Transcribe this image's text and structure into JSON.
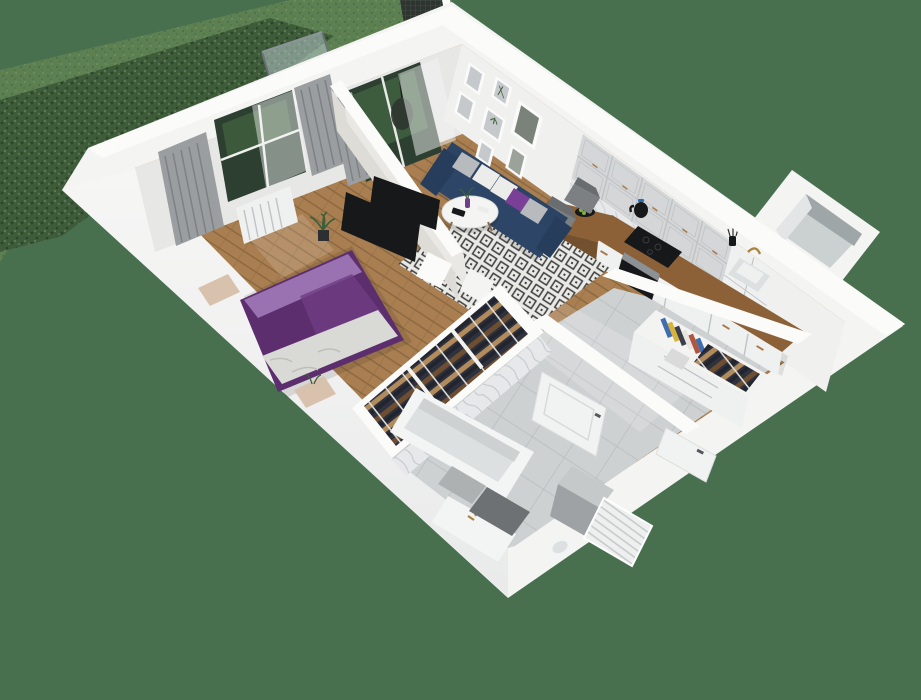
{
  "scene": {
    "type": "3d-floor-plan-render",
    "view": "isometric-cutaway",
    "description": "Rendered cutaway of a one-bedroom apartment with grassy balcony hedge",
    "rooms": [
      {
        "name": "balcony",
        "floor": "grass",
        "items": [
          "hedge",
          "glass-railing",
          "privacy-screen",
          "hanging-egg-chair"
        ]
      },
      {
        "name": "bedroom",
        "floor": "wood-herringbone",
        "items": [
          "double-bed-purple",
          "pillows",
          "white-throw",
          "bedside-bench",
          "foot-bench",
          "window",
          "grey-curtains",
          "sheer-curtain",
          "radiator",
          "wall-tv",
          "potted-plant"
        ]
      },
      {
        "name": "living-room",
        "floor": "wood-herringbone",
        "items": [
          "navy-sofa",
          "throw-pillows",
          "round-coffee-table",
          "vase",
          "patterned-rug",
          "gallery-wall-frames",
          "balcony-door",
          "grey-curtain",
          "sheer-curtain",
          "wall-tv",
          "potted-plant"
        ]
      },
      {
        "name": "kitchen",
        "floor": "wood-herringbone",
        "items": [
          "upper-cabinets",
          "lower-cabinets",
          "wood-countertop",
          "marble-backsplash",
          "induction-hob",
          "built-in-oven",
          "kettle",
          "sink",
          "faucet",
          "utensil-cup",
          "peninsula-table",
          "bar-chair",
          "bar-chair",
          "fruit-bowl",
          "tall-cabinet",
          "duct-shaft"
        ]
      },
      {
        "name": "wardrobe",
        "floor": "none",
        "items": [
          "open-closet",
          "hanging-clothes-rail"
        ]
      },
      {
        "name": "bathroom",
        "floor": "grey-tile",
        "items": [
          "bathtub",
          "wall-tiles",
          "vanity-sink",
          "gold-faucet",
          "toilet",
          "washing-machine",
          "towel-radiator",
          "bath-mat",
          "open-door"
        ]
      },
      {
        "name": "hallway",
        "floor": "grey-tile",
        "items": [
          "storage-unit",
          "book-row",
          "coat-compartment",
          "basket",
          "entrance-door"
        ]
      }
    ]
  },
  "colors": {
    "background": "#48704f",
    "grass": "#5d8052",
    "grass_dot": "#4c6c43",
    "grass_dot_light": "#739459",
    "hedge": "#3e5c39",
    "hedge_dot": "#2c452a",
    "hedge_dot_light": "#5b7d50",
    "slab": "#f4f4f3",
    "wall_top": "#fbfbfa",
    "wall_shade": "#e3e5e6",
    "wall_face_nw": "#e7e7e5",
    "wall_face_ne": "#f0f0ee",
    "partition_face": "#dedcd7",
    "partition_face_light": "#eae8e4",
    "floor_wood": "#a97e50",
    "floor_wood_line": "#8d6941",
    "tile": "#ced1d2",
    "tile_line": "#b8bcbd",
    "rug_bg": "#e9e9e6",
    "rug_line": "#3c3c3c",
    "sofa": "#2d4566",
    "sofa_dark": "#24395510",
    "pillow_grey": "#b8bbbd",
    "pillow_white": "#ececea",
    "pillow_purple": "#7a3f96",
    "bed": "#5c2e6e",
    "bed_light": "#9a72b2",
    "bed_throw": "#d9d9d6",
    "bench": "#d9c2ad",
    "curtain": "#9b9ea1",
    "curtain_stripe": "#7e8184",
    "sheer": "#f2f3f3",
    "glass_dark": "#2c3f31",
    "foliage": "#41603f",
    "rail_glass": "#b7c7cc",
    "frame": "#fafafa",
    "art": "#c6c9cb",
    "cabinet_upper": "#d4d6d7",
    "cabinet_lower": "#eff0f0",
    "cabinet_line": "#c0c3c5",
    "counter": "#8d6138",
    "counter_dark": "#73502e",
    "marble": "#e6e8ea",
    "marble_vein": "#c2c7cd",
    "appliance": "#17181a",
    "steel": "#8e9194",
    "bronze": "#a87a4c",
    "chair": "#7d8083",
    "clothes_a": "#2e323e",
    "clothes_b": "#6e4e30",
    "clothes_c": "#23252e",
    "clothes_d": "#b28b5c",
    "rail_white": "#dcdcda",
    "tub": "#f3f4f4",
    "tub_inner": "#dde0e1",
    "mat": "#6e7173",
    "mat_light": "#aeb1b2",
    "radiator": "#eef0f0",
    "radiator_line": "#c7cbcb",
    "door": "#f1f2f2",
    "door_line": "#d7d9da",
    "handle": "#55585a",
    "book_blue": "#3f6db0",
    "book_yellow": "#d9b33a",
    "book_dark": "#3a3f4a",
    "book_red": "#b2553f",
    "book_white": "#e8e6e0",
    "plant": "#3f5f3a",
    "plant_pot": "#2e2f31",
    "fruit": "#7fae3e",
    "vase": "#6d3f8a",
    "shadow": "#1c241c",
    "shaft_inner": "#cbd0d1",
    "shaft_dark": "#9fa6a8",
    "mesh": "#2e3430",
    "mesh_line": "#4a524c",
    "sunlight": "#ffffff"
  }
}
